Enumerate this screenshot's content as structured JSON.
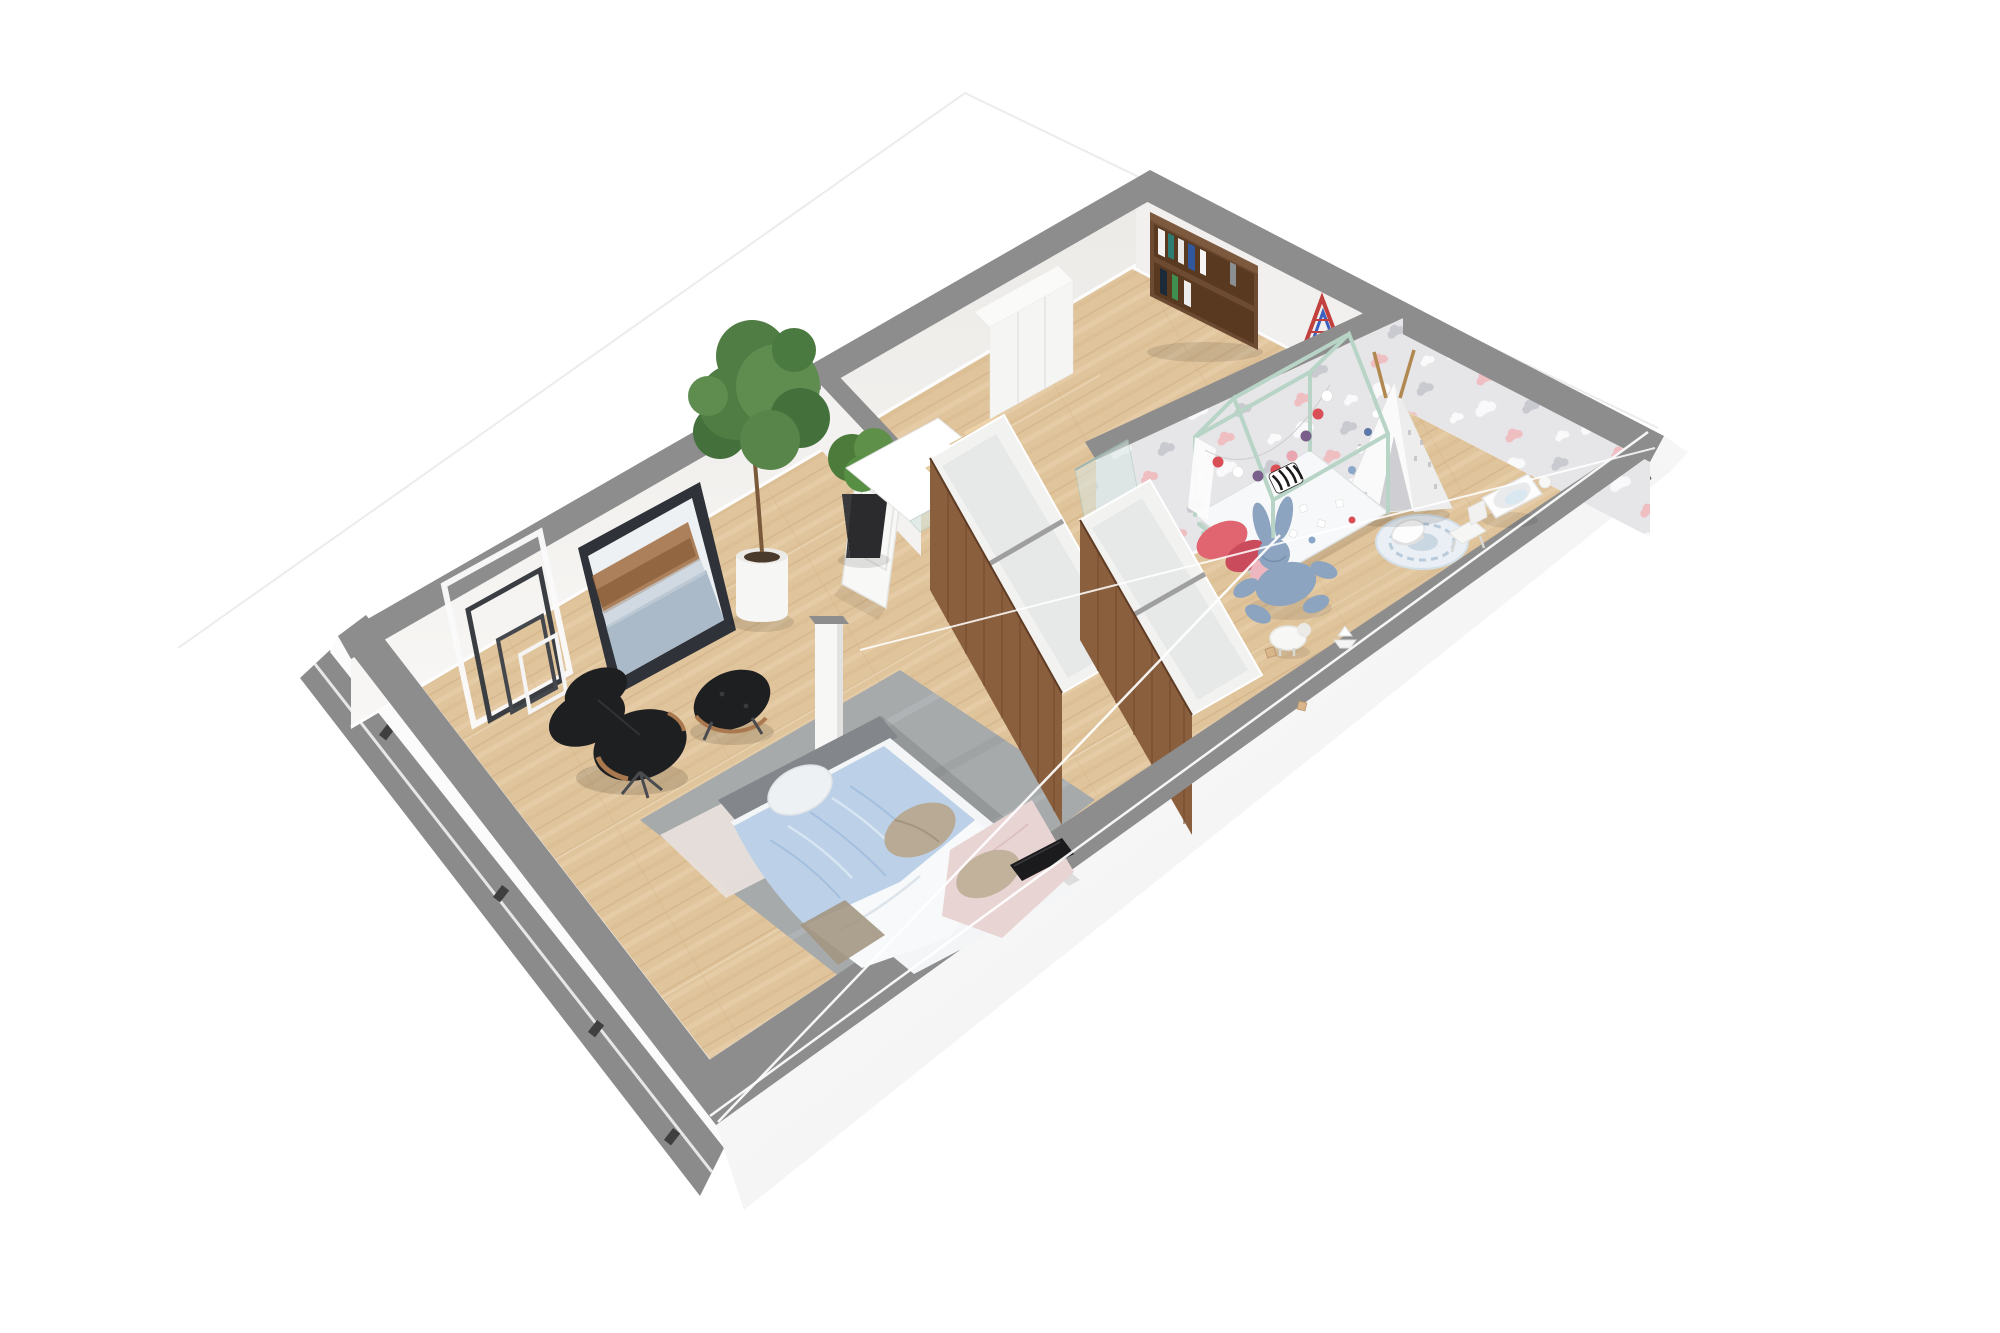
{
  "scene": {
    "type": "3d-floor-plan-cutaway-render",
    "view": "axonometric top-down dollhouse view, rotated ~30 degrees",
    "floor": "upper floor of a duplex apartment",
    "background": "#ffffff",
    "visible_text": ""
  },
  "palette": {
    "bg": "#ffffff",
    "roof_outline": "#ececec",
    "roof_wire": "#ffffff",
    "wall_cap": "#8d8d8d",
    "wall_face": "#f1f0ee",
    "fascia": "#fbfbfb",
    "slab_side": "#8b8b8b",
    "floor_wood": "#e0c49c",
    "stair_wood": "#ecd2a8",
    "rug_gray": "#a6aaab",
    "rug_runner": "#e7dfdb",
    "duvet_blue": "#bcd1e8",
    "sheet_white": "#f3f5f7",
    "pillow_beige": "#b9aa95",
    "blanket_pink": "#e9d4d4",
    "headboard": "#83868a",
    "chair_black": "#1e1f21",
    "chair_wood": "#a9784e",
    "plant_green": "#4f7d43",
    "pot_white": "#f6f6f4",
    "pot_black": "#2b2b2d",
    "door_white": "#f8f8f7",
    "closet_wood": "#8a5f3e",
    "glass": "#d7e7e2",
    "wallpaper_base": "#e6e6e9",
    "wallpaper_cloud_white": "#fbfbfd",
    "wallpaper_cloud_gray": "#c6c6cd",
    "wallpaper_cloud_pink": "#f0b9bd",
    "mint": "#b7d4c6",
    "garland_red": "#d94f55",
    "garland_purple": "#7a5f8a",
    "plush_blue": "#8ca4c0",
    "tv_black": "#1b1b1d",
    "bookshelf_wood": "#6d4b33",
    "triangle_red": "#c2413f",
    "triangle_blue": "#3b5fc0"
  },
  "rooms": {
    "master_bedroom": {
      "label": "master bedroom",
      "contents": [
        "leaning decorative frames",
        "abstract painting",
        "fiddle leaf fig in white pot",
        "shrub in black pot",
        "open white door",
        "eames lounge chair",
        "eames ottoman",
        "gray area rug",
        "light runner rug",
        "double bed with blue duvet, pink blanket, beige pillows",
        "white column",
        "flat tv leaning at wall cut"
      ]
    },
    "stair_landing": {
      "label": "stairwell and landing",
      "contents": [
        "open stair void",
        "wooden stair treads",
        "glass balustrade",
        "tall white wardrobe"
      ]
    },
    "walk_in_closet": {
      "label": "walk-in closet",
      "contents": [
        "two walnut-front open cabinet rows with white compartments",
        "glass screen"
      ]
    },
    "hallway": {
      "label": "hallway",
      "contents": [
        "walnut bookshelf with books",
        "climbing triangle (red/blue)"
      ]
    },
    "kids_room": {
      "label": "children's room",
      "contents": [
        "cloud wallpaper walls",
        "mint house-frame bed with pom-pom garland",
        "coral pillows",
        "zebra pillow",
        "white teepee tent",
        "blue bunny plush",
        "white sheep toy",
        "round play rug",
        "white rocker toy",
        "bassinet",
        "small white chair",
        "wooden blocks",
        "paper boat"
      ]
    }
  }
}
